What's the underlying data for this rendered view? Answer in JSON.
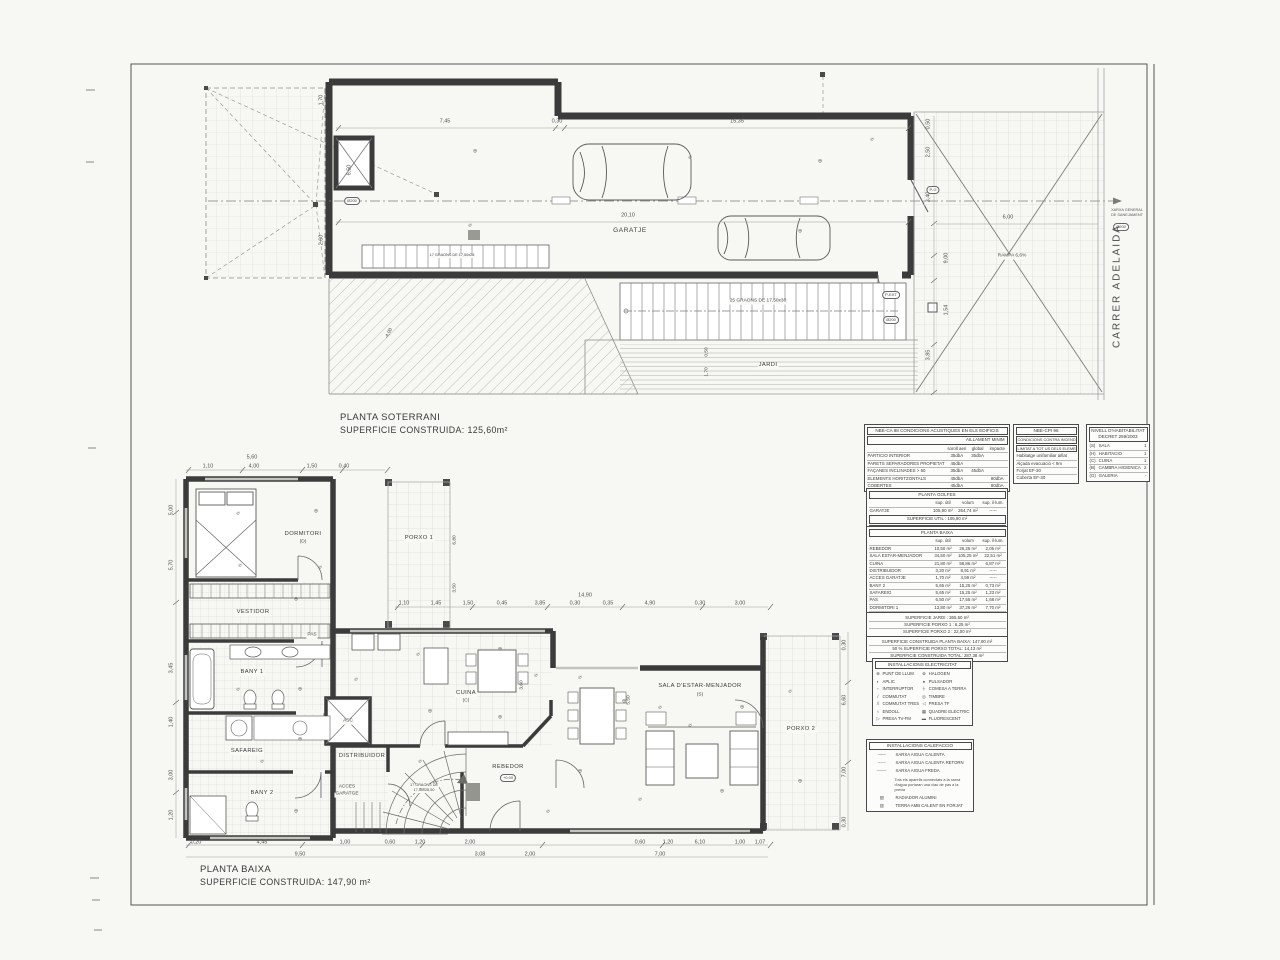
{
  "titles": {
    "soterrani_line1": "PLANTA SOTERRANI",
    "soterrani_line2": "SUPERFICIE CONSTRUIDA: 125,60m²",
    "baixa_line1": "PLANTA BAIXA",
    "baixa_line2": "SUPERFICIE CONSTRUIDA: 147,90 m²"
  },
  "street": {
    "name": "CARRER ADELAIDA"
  },
  "tables": {
    "acoustic": {
      "title": "NBE-CA 88 CONDICIONS ACUSTIQUES EN ELS EDIFICIS",
      "subtitle": "AILLAMENT MINIM",
      "rows": [
        [
          "",
          "soroll aeri",
          "global",
          "impacte"
        ],
        [
          "PARTICIO INTERIOR",
          "35dbA",
          "35dbA",
          ""
        ],
        [
          "PARETS SEPARADORES PROPIETAT",
          "45dbA",
          "",
          ""
        ],
        [
          "FAÇANES INCLINADES > 60",
          "35dbA",
          "45dbA",
          ""
        ],
        [
          "ELEMENTS HORITZONTALS",
          "45dbA",
          "",
          "80dbA"
        ],
        [
          "COBERTES",
          "45dbA",
          "",
          "80dbA"
        ]
      ]
    },
    "fire": {
      "title": "NBE-CPI 96",
      "subtitle1": "CONDICIONS CONTRA INCENDI EN ELS EDIFICIS",
      "subtitle2": "LIMITAT A TOT US DELS ELEMENTS ESTRUCTURALS",
      "rows": [
        [
          "Habitatge unifamiliar aïllat"
        ],
        [
          "Alçada evacuació < 9m"
        ],
        [
          "Forjat EF-30"
        ],
        [
          "Coberta EF-30"
        ]
      ]
    },
    "habitability": {
      "title1": "NIVELL D'HABITABILITAT",
      "title2": "DECRET 259/2003",
      "rows": [
        [
          "(S)",
          "SALA",
          "1"
        ],
        [
          "(H)",
          "HABITACIO",
          "1"
        ],
        [
          "(C)",
          "CUINA",
          "1"
        ],
        [
          "(B)",
          "CAMBRA HIGIENICA",
          "2"
        ],
        [
          "(G)",
          "GALERIA",
          "-"
        ]
      ]
    },
    "golfes": {
      "title": "PLANTA GOLFES",
      "rows": [
        [
          "",
          "sup. útil",
          "volum",
          "sup. il·lum."
        ],
        [
          "GARATJE",
          "105,90 m²",
          "264,74 m²",
          "-----"
        ]
      ],
      "util": "SUPERFICIE UTIL : 105,90 m²",
      "construida": "SUPERFICIE CONSTRUIDA : 125,35 m²"
    },
    "baixa": {
      "title": "PLANTA BAIXA",
      "rows": [
        [
          "",
          "sup. útil",
          "volum",
          "sup. il·lum."
        ],
        [
          "REBEDOR",
          "10,50 m²",
          "26,25 m²",
          "2,05 m²"
        ],
        [
          "SALA ESTAR-MENJADOR",
          "34,50 m²",
          "105,25 m²",
          "22,51 m²"
        ],
        [
          "CUINA",
          "21,80 m²",
          "58,86 m²",
          "6,87 m²"
        ],
        [
          "DISTRIBUIDOR",
          "3,20 m²",
          "8,91 m²",
          "-----"
        ],
        [
          "ACCES GARATJE",
          "1,70 m²",
          "4,59 m²",
          "-----"
        ],
        [
          "BANY 2",
          "5,65 m²",
          "15,25 m²",
          "0,73 m²"
        ],
        [
          "SAFAREIG",
          "5,65 m²",
          "15,25 m²",
          "1,23 m²"
        ],
        [
          "PAS",
          "6,50 m²",
          "17,55 m²",
          "1,68 m²"
        ],
        [
          "DORMITORI 1",
          "13,80 m²",
          "37,26 m²",
          "7,70 m²"
        ],
        [
          "VESTIDOR 1",
          "5,95 m²",
          "16,06 m²",
          "-----"
        ],
        [
          "BANY 1",
          "5,95 m²",
          "16,06 m²",
          "0,96 m²"
        ]
      ],
      "util": "SUPERFICIE UTIL : 115,20 m²"
    },
    "summary_porxo": {
      "rows": [
        [
          "SUPERFICIE JARDI : 365,50 m²"
        ],
        [
          "SUPERFICIE PORXO 1 : 6,25 m²"
        ],
        [
          "SUPERFICIE PORXO 2 : 22,00 m²"
        ]
      ]
    },
    "summary_total": {
      "rows": [
        [
          "SUPERFICIE CONSTRUIDA PLANTA BAIXA: 147,90 m²"
        ],
        [
          "50 % SUPERFICIE PORXO TOTAL: 14,13 m²"
        ],
        [
          "SUPERFICIE CONSTRUIDA TOTAL: 287,38 m²"
        ]
      ]
    }
  },
  "legends": {
    "electric": {
      "title": "INSTALLACIONS ELECTRICITAT",
      "rows": [
        [
          "⊕",
          "PUNT DE LLUM",
          "⊗",
          "HALOGEN"
        ],
        [
          "◐",
          "APLIC",
          "●",
          "PULSADOR"
        ],
        [
          "⌐",
          "INTERRUPTOR",
          "⏚",
          "COMESA A TERRA"
        ],
        [
          "/",
          "COMMUTAT",
          "◎",
          "TIMBRE"
        ],
        [
          "//",
          "COMMUTAT TRES",
          "◁",
          "PRESA TF"
        ],
        [
          "∩",
          "ENDOLL",
          "▦",
          "QUADRE ELECTRIC"
        ],
        [
          "▷",
          "PRESA TV-FM",
          "▬",
          "FLUORESCENT"
        ]
      ]
    },
    "heating": {
      "title": "INSTALLACIONS CALEFACCIO",
      "lines": [
        [
          "——",
          "XARXA AIGUA CALENTA"
        ],
        [
          "– – –",
          "XARXA AIGUA CALENTA RETORN"
        ],
        [
          "—·—·",
          "XARXA AIGUA FREDA"
        ]
      ],
      "note": "Tots els aparells connectats a la xarxa d'aigua portaran una clau de pas a la previa",
      "items": [
        [
          "▨",
          "RADIADOR ALUMINI"
        ],
        [
          "▥",
          "TERRA AMB CALENT EN FORJAT"
        ]
      ]
    }
  },
  "soterrani_overlay": [
    {
      "t": "7,45",
      "x": 445,
      "y": 122
    },
    {
      "t": "0,30",
      "x": 557,
      "y": 122
    },
    {
      "t": "15,35",
      "x": 737,
      "y": 122
    },
    {
      "t": "20,10",
      "x": 628,
      "y": 216
    },
    {
      "t": "GARATJE",
      "x": 630,
      "y": 231,
      "c": "room",
      "n": "room-label-garatje"
    },
    {
      "t": "JARDI",
      "x": 768,
      "y": 366,
      "c": "room-s chip",
      "n": "room-label-jardi"
    },
    {
      "t": "RAMPA 6,6%",
      "x": 1012,
      "y": 257,
      "c": "tiny chip",
      "n": "ramp-label"
    },
    {
      "t": "6,00",
      "x": 1008,
      "y": 218
    },
    {
      "t": "0,50",
      "x": 929,
      "y": 124,
      "r": -90
    },
    {
      "t": "2,50",
      "x": 929,
      "y": 152,
      "r": -90
    },
    {
      "t": "3,40",
      "x": 929,
      "y": 197,
      "r": -90
    },
    {
      "t": "9,00",
      "x": 947,
      "y": 258,
      "r": -90
    },
    {
      "t": "1,54",
      "x": 947,
      "y": 310,
      "r": -90
    },
    {
      "t": "3,85",
      "x": 929,
      "y": 355,
      "r": -90
    },
    {
      "t": "1,70",
      "x": 322,
      "y": 100,
      "r": -90
    },
    {
      "t": "6,50",
      "x": 350,
      "y": 170,
      "r": -90
    },
    {
      "t": "2,60",
      "x": 322,
      "y": 240,
      "r": -90
    },
    {
      "t": "-4,00",
      "x": 390,
      "y": 334,
      "r": -62,
      "c": "tiny"
    },
    {
      "t": "25 GRAONS DE 17,50x30",
      "x": 758,
      "y": 302,
      "c": "tiny chip",
      "n": "stairs-note"
    },
    {
      "t": "17 GRAONS DE 17,50x28",
      "x": 452,
      "y": 256,
      "c": "tiny2 chip",
      "n": "garage-stairs-note"
    },
    {
      "t": "0,50",
      "x": 708,
      "y": 352,
      "r": -90,
      "c": "tiny"
    },
    {
      "t": "1,70",
      "x": 708,
      "y": 372,
      "r": -90,
      "c": "tiny"
    },
    {
      "t": "P-G",
      "x": 933,
      "y": 190,
      "c": "oval",
      "n": "door-tag-pg"
    },
    {
      "t": "P-EXT",
      "x": 891,
      "y": 295,
      "c": "oval",
      "n": "door-tag-pext"
    },
    {
      "t": "Ø200",
      "x": 352,
      "y": 201,
      "c": "oval"
    },
    {
      "t": "Ø200",
      "x": 891,
      "y": 320,
      "c": "oval"
    },
    {
      "t": "XARXA GENERAL",
      "x": 1127,
      "y": 211,
      "c": "tiny3",
      "n": "sewer-note"
    },
    {
      "t": "DE SANEJAMENT",
      "x": 1127,
      "y": 216,
      "c": "tiny3",
      "n": "sewer-note"
    },
    {
      "t": "Ø200",
      "x": 1121,
      "y": 227,
      "c": "oval"
    },
    {
      "t": "⊕",
      "x": 475,
      "y": 152,
      "c": "sym",
      "n": "electric-symbol"
    },
    {
      "t": "⌀",
      "x": 690,
      "y": 158,
      "c": "sym",
      "n": "electric-symbol"
    },
    {
      "t": "⊕",
      "x": 820,
      "y": 162,
      "c": "sym",
      "n": "electric-symbol"
    },
    {
      "t": "⌀",
      "x": 470,
      "y": 226,
      "c": "sym",
      "n": "electric-symbol"
    },
    {
      "t": "⊕",
      "x": 800,
      "y": 232,
      "c": "sym",
      "n": "electric-symbol"
    },
    {
      "t": "⌀",
      "x": 872,
      "y": 140,
      "c": "sym",
      "n": "electric-symbol"
    }
  ],
  "baixa_overlay": [
    {
      "t": "DORMITORI",
      "x": 303,
      "y": 535,
      "c": "room-s",
      "n": "room-label-dormitori"
    },
    {
      "t": "(D)",
      "x": 303,
      "y": 543,
      "c": "tiny"
    },
    {
      "t": "PORXO 1",
      "x": 419,
      "y": 539,
      "c": "room-s chip",
      "n": "room-label-porxo1"
    },
    {
      "t": "VESTIDOR",
      "x": 253,
      "y": 613,
      "c": "room-s chip",
      "n": "room-label-vestidor"
    },
    {
      "t": "PAS",
      "x": 312,
      "y": 636,
      "c": "tiny chip",
      "n": "room-label-pas"
    },
    {
      "t": "BANY 1",
      "x": 252,
      "y": 673,
      "c": "room-s chip",
      "n": "room-label-bany1"
    },
    {
      "t": "SAFAREIG",
      "x": 247,
      "y": 752,
      "c": "room-s chip",
      "n": "room-label-safareig"
    },
    {
      "t": "BANY 2",
      "x": 262,
      "y": 794,
      "c": "room-s chip",
      "n": "room-label-bany2"
    },
    {
      "t": "ASC",
      "x": 348,
      "y": 722,
      "c": "tiny chip",
      "n": "room-label-asc"
    },
    {
      "t": "DISTRIBUIDOR",
      "x": 362,
      "y": 757,
      "c": "room-s chip",
      "n": "room-label-distribuidor"
    },
    {
      "t": "ACCES",
      "x": 347,
      "y": 788,
      "c": "tiny chip",
      "n": "room-label-acces-garatge"
    },
    {
      "t": "GARATGE",
      "x": 347,
      "y": 795,
      "c": "tiny chip",
      "n": "room-label-acces-garatge"
    },
    {
      "t": "REBEDOR",
      "x": 508,
      "y": 768,
      "c": "room-s",
      "n": "room-label-rebedor"
    },
    {
      "t": "+0,00",
      "x": 508,
      "y": 778,
      "c": "oval",
      "n": "level-tag"
    },
    {
      "t": "CUINA",
      "x": 466,
      "y": 694,
      "c": "room-s chip",
      "n": "room-label-cuina"
    },
    {
      "t": "(C)",
      "x": 466,
      "y": 702,
      "c": "tiny chip"
    },
    {
      "t": "SALA D'ESTAR-MENJADOR",
      "x": 700,
      "y": 687,
      "c": "room-s",
      "n": "room-label-sala"
    },
    {
      "t": "(S)",
      "x": 700,
      "y": 696,
      "c": "tiny"
    },
    {
      "t": "PORXO 2",
      "x": 801,
      "y": 730,
      "c": "room-s chip",
      "n": "room-label-porxo2"
    },
    {
      "t": "17 GRAONS DE",
      "x": 424,
      "y": 786,
      "c": "tiny2 chip",
      "n": "stair-note"
    },
    {
      "t": "17,50x28,50",
      "x": 424,
      "y": 791,
      "c": "tiny2 chip"
    },
    {
      "t": "5,60",
      "x": 252,
      "y": 458
    },
    {
      "t": "1,10",
      "x": 208,
      "y": 467
    },
    {
      "t": "4,00",
      "x": 254,
      "y": 467
    },
    {
      "t": "1,50",
      "x": 312,
      "y": 467
    },
    {
      "t": "0,40",
      "x": 344,
      "y": 467
    },
    {
      "t": "14,90",
      "x": 585,
      "y": 596
    },
    {
      "t": "1,10",
      "x": 404,
      "y": 604
    },
    {
      "t": "1,45",
      "x": 436,
      "y": 604
    },
    {
      "t": "1,50",
      "x": 468,
      "y": 604
    },
    {
      "t": "0,45",
      "x": 502,
      "y": 604
    },
    {
      "t": "3,85",
      "x": 540,
      "y": 604
    },
    {
      "t": "0,30",
      "x": 575,
      "y": 604
    },
    {
      "t": "0,35",
      "x": 608,
      "y": 604
    },
    {
      "t": "4,90",
      "x": 650,
      "y": 604
    },
    {
      "t": "0,30",
      "x": 700,
      "y": 604
    },
    {
      "t": "3,00",
      "x": 740,
      "y": 604
    },
    {
      "t": "5,00",
      "x": 172,
      "y": 510,
      "r": -90
    },
    {
      "t": "5,70",
      "x": 172,
      "y": 565,
      "r": -90
    },
    {
      "t": "3,45",
      "x": 172,
      "y": 668,
      "r": -90
    },
    {
      "t": "1,40",
      "x": 172,
      "y": 722,
      "r": -90
    },
    {
      "t": "3,00",
      "x": 172,
      "y": 775,
      "r": -90
    },
    {
      "t": "1,20",
      "x": 172,
      "y": 815,
      "r": -90
    },
    {
      "t": "0,30",
      "x": 845,
      "y": 645,
      "r": -90
    },
    {
      "t": "6,60",
      "x": 845,
      "y": 700,
      "r": -90
    },
    {
      "t": "7,00",
      "x": 845,
      "y": 772,
      "r": -90
    },
    {
      "t": "0,30",
      "x": 845,
      "y": 822,
      "r": -90
    },
    {
      "t": "6,80",
      "x": 456,
      "y": 540,
      "r": -90,
      "c": "tiny"
    },
    {
      "t": "3,50",
      "x": 456,
      "y": 588,
      "r": -90,
      "c": "tiny"
    },
    {
      "t": "3,60",
      "x": 523,
      "y": 685,
      "r": -90,
      "c": "tiny"
    },
    {
      "t": "5,50",
      "x": 630,
      "y": 700,
      "r": -90,
      "c": "tiny"
    },
    {
      "t": "0,20",
      "x": 196,
      "y": 843
    },
    {
      "t": "4,45",
      "x": 262,
      "y": 843
    },
    {
      "t": "1,00",
      "x": 345,
      "y": 843
    },
    {
      "t": "0,60",
      "x": 390,
      "y": 843
    },
    {
      "t": "1,20",
      "x": 420,
      "y": 843
    },
    {
      "t": "2,00",
      "x": 470,
      "y": 843
    },
    {
      "t": "0,60",
      "x": 640,
      "y": 843
    },
    {
      "t": "1,20",
      "x": 668,
      "y": 843
    },
    {
      "t": "6,10",
      "x": 700,
      "y": 843
    },
    {
      "t": "1,00",
      "x": 740,
      "y": 843
    },
    {
      "t": "1,07",
      "x": 760,
      "y": 843
    },
    {
      "t": "9,50",
      "x": 300,
      "y": 855
    },
    {
      "t": "3,08",
      "x": 480,
      "y": 855
    },
    {
      "t": "2,00",
      "x": 530,
      "y": 855
    },
    {
      "t": "7,00",
      "x": 660,
      "y": 855
    },
    {
      "t": "⌀",
      "x": 238,
      "y": 514,
      "c": "sym",
      "n": "electric-symbol"
    },
    {
      "t": "⊕",
      "x": 316,
      "y": 512,
      "c": "sym",
      "n": "electric-symbol"
    },
    {
      "t": "⌀",
      "x": 240,
      "y": 566,
      "c": "sym",
      "n": "electric-symbol"
    },
    {
      "t": "⌀",
      "x": 320,
      "y": 568,
      "c": "sym",
      "n": "electric-symbol"
    },
    {
      "t": "⊕",
      "x": 296,
      "y": 600,
      "c": "sym",
      "n": "electric-symbol"
    },
    {
      "t": "⌀",
      "x": 238,
      "y": 690,
      "c": "sym",
      "n": "electric-symbol"
    },
    {
      "t": "⊕",
      "x": 300,
      "y": 690,
      "c": "sym",
      "n": "electric-symbol"
    },
    {
      "t": "⌀",
      "x": 418,
      "y": 655,
      "c": "sym",
      "n": "electric-symbol"
    },
    {
      "t": "⊕",
      "x": 430,
      "y": 712,
      "c": "sym",
      "n": "electric-symbol"
    },
    {
      "t": "⌀",
      "x": 356,
      "y": 680,
      "c": "sym",
      "n": "electric-symbol"
    },
    {
      "t": "⊕",
      "x": 300,
      "y": 740,
      "c": "sym",
      "n": "electric-symbol"
    },
    {
      "t": "⌀",
      "x": 262,
      "y": 762,
      "c": "sym",
      "n": "electric-symbol"
    },
    {
      "t": "⊕",
      "x": 296,
      "y": 812,
      "c": "sym",
      "n": "electric-symbol"
    },
    {
      "t": "⌀",
      "x": 420,
      "y": 762,
      "c": "sym",
      "n": "electric-symbol"
    },
    {
      "t": "⊕",
      "x": 500,
      "y": 718,
      "c": "sym",
      "n": "electric-symbol"
    },
    {
      "t": "⌀",
      "x": 536,
      "y": 676,
      "c": "sym",
      "n": "electric-symbol"
    },
    {
      "t": "⊕",
      "x": 500,
      "y": 650,
      "c": "sym",
      "n": "electric-symbol"
    },
    {
      "t": "⌀",
      "x": 580,
      "y": 678,
      "c": "sym",
      "n": "electric-symbol"
    },
    {
      "t": "⊕",
      "x": 624,
      "y": 702,
      "c": "sym",
      "n": "electric-symbol"
    },
    {
      "t": "⌀",
      "x": 660,
      "y": 708,
      "c": "sym",
      "n": "electric-symbol"
    },
    {
      "t": "⊕",
      "x": 742,
      "y": 708,
      "c": "sym",
      "n": "electric-symbol"
    },
    {
      "t": "⌀",
      "x": 690,
      "y": 726,
      "c": "sym",
      "n": "electric-symbol"
    },
    {
      "t": "⊕",
      "x": 580,
      "y": 772,
      "c": "sym",
      "n": "electric-symbol"
    },
    {
      "t": "⌀",
      "x": 640,
      "y": 800,
      "c": "sym",
      "n": "electric-symbol"
    },
    {
      "t": "⊕",
      "x": 722,
      "y": 792,
      "c": "sym",
      "n": "electric-symbol"
    },
    {
      "t": "⌀",
      "x": 790,
      "y": 692,
      "c": "sym",
      "n": "electric-symbol"
    },
    {
      "t": "⊕",
      "x": 800,
      "y": 782,
      "c": "sym",
      "n": "electric-symbol"
    },
    {
      "t": "⌀",
      "x": 548,
      "y": 812,
      "c": "sym",
      "n": "electric-symbol"
    }
  ]
}
